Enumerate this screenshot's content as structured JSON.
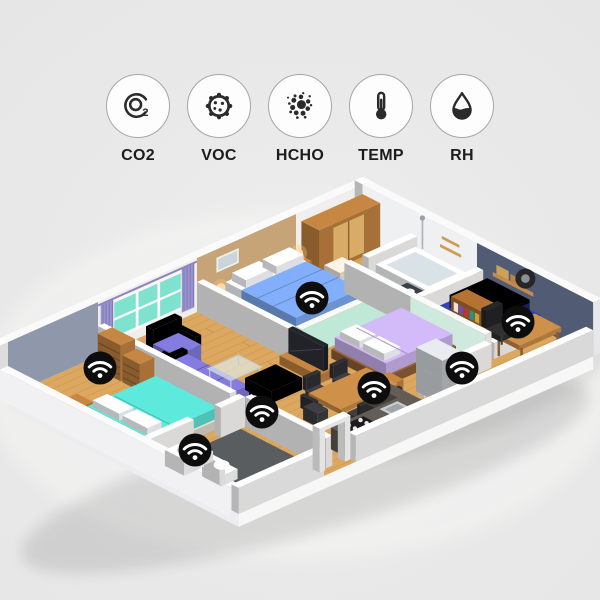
{
  "sensor_row": {
    "items": [
      {
        "id": "co2",
        "label": "CO2",
        "icon": "co2-molecule-icon"
      },
      {
        "id": "voc",
        "label": "VOC",
        "icon": "voc-particle-icon"
      },
      {
        "id": "hcho",
        "label": "HCHO",
        "icon": "hcho-particles-icon"
      },
      {
        "id": "temp",
        "label": "TEMP",
        "icon": "thermometer-icon"
      },
      {
        "id": "rh",
        "label": "RH",
        "icon": "humidity-droplet-icon"
      }
    ]
  },
  "floorplan": {
    "wifi_marker_count": 7,
    "wifi_markers": [
      {
        "x": 100,
        "y": 368,
        "area": "left-bedroom"
      },
      {
        "x": 195,
        "y": 450,
        "area": "bathroom"
      },
      {
        "x": 262,
        "y": 412,
        "area": "living-room"
      },
      {
        "x": 312,
        "y": 298,
        "area": "master-bedroom"
      },
      {
        "x": 374,
        "y": 388,
        "area": "second-bedroom"
      },
      {
        "x": 462,
        "y": 368,
        "area": "study"
      },
      {
        "x": 518,
        "y": 322,
        "area": "garage"
      }
    ],
    "colors": {
      "background": "#e9e9e9",
      "floor_wood": "#dca860",
      "wall_white": "#f2f1f0",
      "accent_blue_gray": "#8f98aa",
      "accent_tan": "#c7a478",
      "accent_slate": "#515c74",
      "accent_mint": "#bfe8d6",
      "window_teal": "#7fe2cf",
      "curtain_purple": "#9a93d4",
      "sofa_purple": "#7a73d0",
      "bed_teal": "#56d9cc",
      "bed_blue": "#78a2e8",
      "bed_lavender": "#c3ace6",
      "wood_furniture": "#b97c3e",
      "car_blue": "#2f3da8",
      "counter_dark": "#5d5650",
      "bath_floor_dark": "#5a5d60",
      "marker_black": "#0d0d0d",
      "icon_circle_border": "#a6a6a6",
      "icon_glyph": "#2b2b2b",
      "label_color": "#1c1c1c"
    }
  }
}
